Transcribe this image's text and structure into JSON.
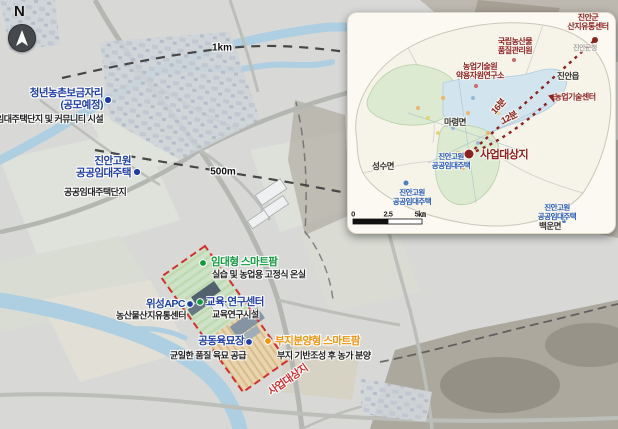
{
  "compass": {
    "label": "N"
  },
  "scale_labels": {
    "km1": "1km",
    "m500": "500m"
  },
  "markers": {
    "youth": {
      "line1": "청년농촌보금자리",
      "line2": "(공모예정)",
      "desc": "임대주택단지 및 커뮤니티 시설"
    },
    "plateau": {
      "line1": "진안고원",
      "line2": "공공임대주택",
      "desc": "공공임대주택단지"
    }
  },
  "site": {
    "boundary_label": "사업대상지",
    "facilities": {
      "rental": {
        "label": "임대형 스마트팜",
        "desc": "실습 및 농업용 고정식 온실"
      },
      "apc": {
        "label": "위성APC",
        "desc": "농산물산지유통센터"
      },
      "edu": {
        "label": "교육·연구센터",
        "desc": "교육연구시설"
      },
      "nursery": {
        "label": "공동육묘장",
        "desc": "균일한 품질 육묘 공급"
      },
      "parcel": {
        "label": "부지분양형 스마트팜",
        "desc": "부지 기반조성 후 농가 분양"
      }
    }
  },
  "colors": {
    "site_boundary": "#d32f2f",
    "label_blue": "#1e3ea6",
    "label_green": "#0f9a3c",
    "label_orange": "#f0920a",
    "inset_maroon": "#8e1f1f",
    "inset_blue": "#2458b8"
  },
  "inset": {
    "pois": {
      "distribution": {
        "line1": "진안군",
        "line2": "산지유통센터"
      },
      "quality": {
        "line1": "국립농산물",
        "line2": "품질관리원"
      },
      "herb": {
        "line1": "농업기술원",
        "line2": "약용자원연구소"
      },
      "agtech": {
        "label": "농업기술센터"
      },
      "site": {
        "label": "사업대상지"
      }
    },
    "districts": {
      "jinan": "진안읍",
      "maryeong": "마령면",
      "seongsu": "성수면",
      "baegun": "백운면"
    },
    "housing_center": {
      "line1": "진안고원",
      "line2": "공공임대주택"
    },
    "housing_sw": {
      "line1": "진안고원",
      "line2": "공공임대주택"
    },
    "housing_se": {
      "line1": "진안고원",
      "line2": "공공임대주택"
    },
    "times": {
      "t16": "16분",
      "t12": "12분"
    },
    "scalebar": {
      "zero": "0",
      "mid": "2.5",
      "max": "5㎞"
    },
    "faint": "진안군청"
  }
}
